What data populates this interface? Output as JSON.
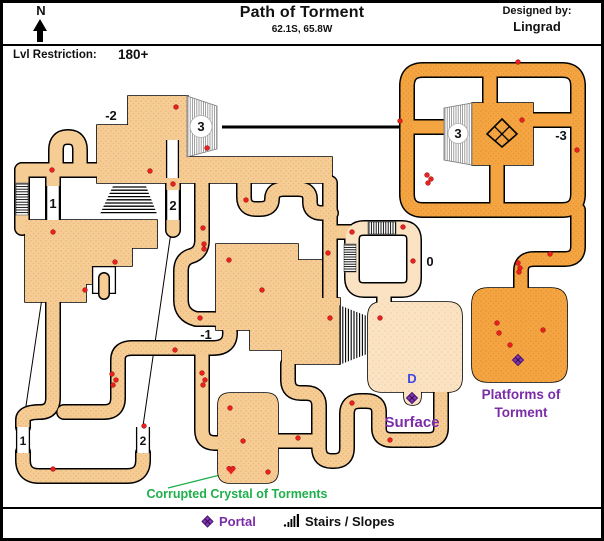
{
  "header": {
    "compass": "N",
    "title": "Path of Torment",
    "subtitle": "62.1S, 65.8W",
    "designed_by_label": "Designed by:",
    "designer": "Lingrad",
    "level_label": "Lvl Restriction:",
    "level_value": "180+"
  },
  "legend": {
    "portal_label": "Portal",
    "stairs_label": "Stairs / Slopes"
  },
  "colors": {
    "tan": "#F6CC95",
    "orange": "#F4A440",
    "light": "#FAE2C2",
    "red": "#E9201D",
    "red_dark": "#8F0F0F",
    "green": "#1FAF4B",
    "purple": "#7B2CA8",
    "purple_dark": "#47186B",
    "blue": "#4247E3",
    "label": "#111111",
    "outline": "#000000"
  },
  "map": {
    "labels": [
      {
        "text": "-2",
        "x": 111,
        "y": 120,
        "size": 13,
        "color": "label"
      },
      {
        "text": "3",
        "x": 201,
        "y": 131,
        "size": 13,
        "color": "label",
        "circle": 11
      },
      {
        "text": "3",
        "x": 458,
        "y": 138,
        "size": 13,
        "color": "label",
        "circle": 10
      },
      {
        "text": "-3",
        "x": 561,
        "y": 140,
        "size": 13,
        "color": "label"
      },
      {
        "text": "1",
        "x": 53,
        "y": 208,
        "size": 13,
        "color": "label"
      },
      {
        "text": "2",
        "x": 173,
        "y": 210,
        "size": 13,
        "color": "label"
      },
      {
        "text": "0",
        "x": 430,
        "y": 266,
        "size": 13,
        "color": "label"
      },
      {
        "text": "-1",
        "x": 206,
        "y": 339,
        "size": 13,
        "color": "label"
      },
      {
        "text": "1",
        "x": 23,
        "y": 445,
        "size": 12,
        "color": "label"
      },
      {
        "text": "2",
        "x": 143,
        "y": 445,
        "size": 12,
        "color": "label"
      },
      {
        "text": "D",
        "x": 412,
        "y": 383,
        "size": 13,
        "color": "blue"
      },
      {
        "text": "Surface",
        "x": 412,
        "y": 427,
        "size": 15,
        "color": "purple"
      },
      {
        "text": "Platforms of",
        "x": 521,
        "y": 399,
        "size": 13.5,
        "color": "purple"
      },
      {
        "text": "Torment",
        "x": 521,
        "y": 417,
        "size": 13.5,
        "color": "purple"
      },
      {
        "text": "Corrupted Crystal of Torments",
        "x": 237,
        "y": 498,
        "size": 12.5,
        "color": "green"
      }
    ],
    "gaps": [
      {
        "x": 46,
        "y": 186,
        "w": 14,
        "h": 34,
        "walls": "lr"
      },
      {
        "x": 166,
        "y": 190,
        "w": 14,
        "h": 30,
        "walls": "lr"
      },
      {
        "x": 16,
        "y": 427,
        "w": 14,
        "h": 26,
        "walls": "lr"
      },
      {
        "x": 136,
        "y": 427,
        "w": 14,
        "h": 26,
        "walls": "lr"
      },
      {
        "x": 166,
        "y": 140,
        "w": 13,
        "h": 38,
        "walls": "lr"
      },
      {
        "x": 92,
        "y": 266,
        "w": 24,
        "h": 28,
        "walls": "all"
      }
    ],
    "stairs": [
      {
        "shape": [
          [
            187,
            96
          ],
          [
            217,
            106
          ],
          [
            217,
            149
          ],
          [
            187,
            157
          ]
        ],
        "dir": "v",
        "bg": true,
        "line": "#888888",
        "gap": 2.2,
        "lw": 0.8
      },
      {
        "shape": [
          [
            444,
            108
          ],
          [
            472,
            103
          ],
          [
            472,
            165
          ],
          [
            444,
            160
          ]
        ],
        "dir": "v",
        "bg": true,
        "line": "#888888",
        "gap": 2.2,
        "lw": 0.8
      },
      {
        "shape": [
          [
            113,
            186
          ],
          [
            146,
            186
          ],
          [
            157,
            214
          ],
          [
            100,
            214
          ]
        ],
        "dir": "h",
        "bg": false,
        "line": "#000000",
        "gap": 3.2,
        "lw": 1.3
      },
      {
        "shape": [
          [
            339,
            305
          ],
          [
            367,
            316
          ],
          [
            367,
            354
          ],
          [
            339,
            365
          ]
        ],
        "dir": "v",
        "bg": false,
        "line": "#000000",
        "gap": 2.8,
        "lw": 1.1
      },
      {
        "shape": [
          [
            16,
            183
          ],
          [
            28,
            183
          ],
          [
            28,
            215
          ],
          [
            16,
            215
          ]
        ],
        "dir": "h",
        "bg": true,
        "line": "#000000",
        "gap": 2.6,
        "lw": 0.9
      },
      {
        "shape": [
          [
            368,
            222
          ],
          [
            396,
            222
          ],
          [
            396,
            234
          ],
          [
            368,
            234
          ]
        ],
        "dir": "v",
        "bg": true,
        "line": "#000000",
        "gap": 2.4,
        "lw": 0.9
      },
      {
        "shape": [
          [
            344,
            244
          ],
          [
            356,
            244
          ],
          [
            356,
            272
          ],
          [
            344,
            272
          ]
        ],
        "dir": "h",
        "bg": true,
        "line": "#000000",
        "gap": 2.4,
        "lw": 0.9
      }
    ],
    "portals": [
      {
        "x": 412,
        "y": 398,
        "style": "gate"
      },
      {
        "x": 518,
        "y": 360,
        "style": "gate"
      },
      {
        "x": 502,
        "y": 134,
        "style": "waypoint"
      }
    ],
    "dots": [
      [
        176,
        107
      ],
      [
        207,
        148
      ],
      [
        150,
        171
      ],
      [
        52,
        170
      ],
      [
        173,
        184
      ],
      [
        53,
        232
      ],
      [
        115,
        262
      ],
      [
        85,
        290
      ],
      [
        112,
        374
      ],
      [
        116,
        380
      ],
      [
        113,
        385
      ],
      [
        202,
        373
      ],
      [
        205,
        380
      ],
      [
        203,
        385
      ],
      [
        175,
        350
      ],
      [
        200,
        318
      ],
      [
        203,
        228
      ],
      [
        204,
        244
      ],
      [
        204,
        249
      ],
      [
        246,
        200
      ],
      [
        53,
        469
      ],
      [
        144,
        426
      ],
      [
        229,
        260
      ],
      [
        262,
        290
      ],
      [
        330,
        318
      ],
      [
        380,
        318
      ],
      [
        328,
        253
      ],
      [
        352,
        232
      ],
      [
        403,
        227
      ],
      [
        413,
        261
      ],
      [
        298,
        438
      ],
      [
        352,
        403
      ],
      [
        390,
        440
      ],
      [
        230,
        408
      ],
      [
        243,
        441
      ],
      [
        268,
        472
      ],
      [
        518,
        62
      ],
      [
        400,
        121
      ],
      [
        522,
        120
      ],
      [
        577,
        150
      ],
      [
        427,
        175
      ],
      [
        431,
        179
      ],
      [
        428,
        183
      ],
      [
        550,
        254
      ],
      [
        518,
        263
      ],
      [
        520,
        268
      ],
      [
        519,
        272
      ],
      [
        497,
        323
      ],
      [
        499,
        333
      ],
      [
        510,
        345
      ],
      [
        543,
        330
      ]
    ],
    "crystal": {
      "x": 231,
      "y": 470
    },
    "callouts": [
      {
        "x1": 222,
        "y1": 127,
        "x2": 445,
        "y2": 127,
        "color": "#000000",
        "w": 3
      },
      {
        "x1": 53,
        "y1": 224,
        "x2": 23,
        "y2": 426,
        "color": "#000000",
        "w": 1
      },
      {
        "x1": 171,
        "y1": 232,
        "x2": 143,
        "y2": 426,
        "color": "#000000",
        "w": 1
      },
      {
        "x1": 232,
        "y1": 472,
        "x2": 168,
        "y2": 488,
        "color": "#1FAF4B",
        "w": 1.3
      }
    ]
  }
}
